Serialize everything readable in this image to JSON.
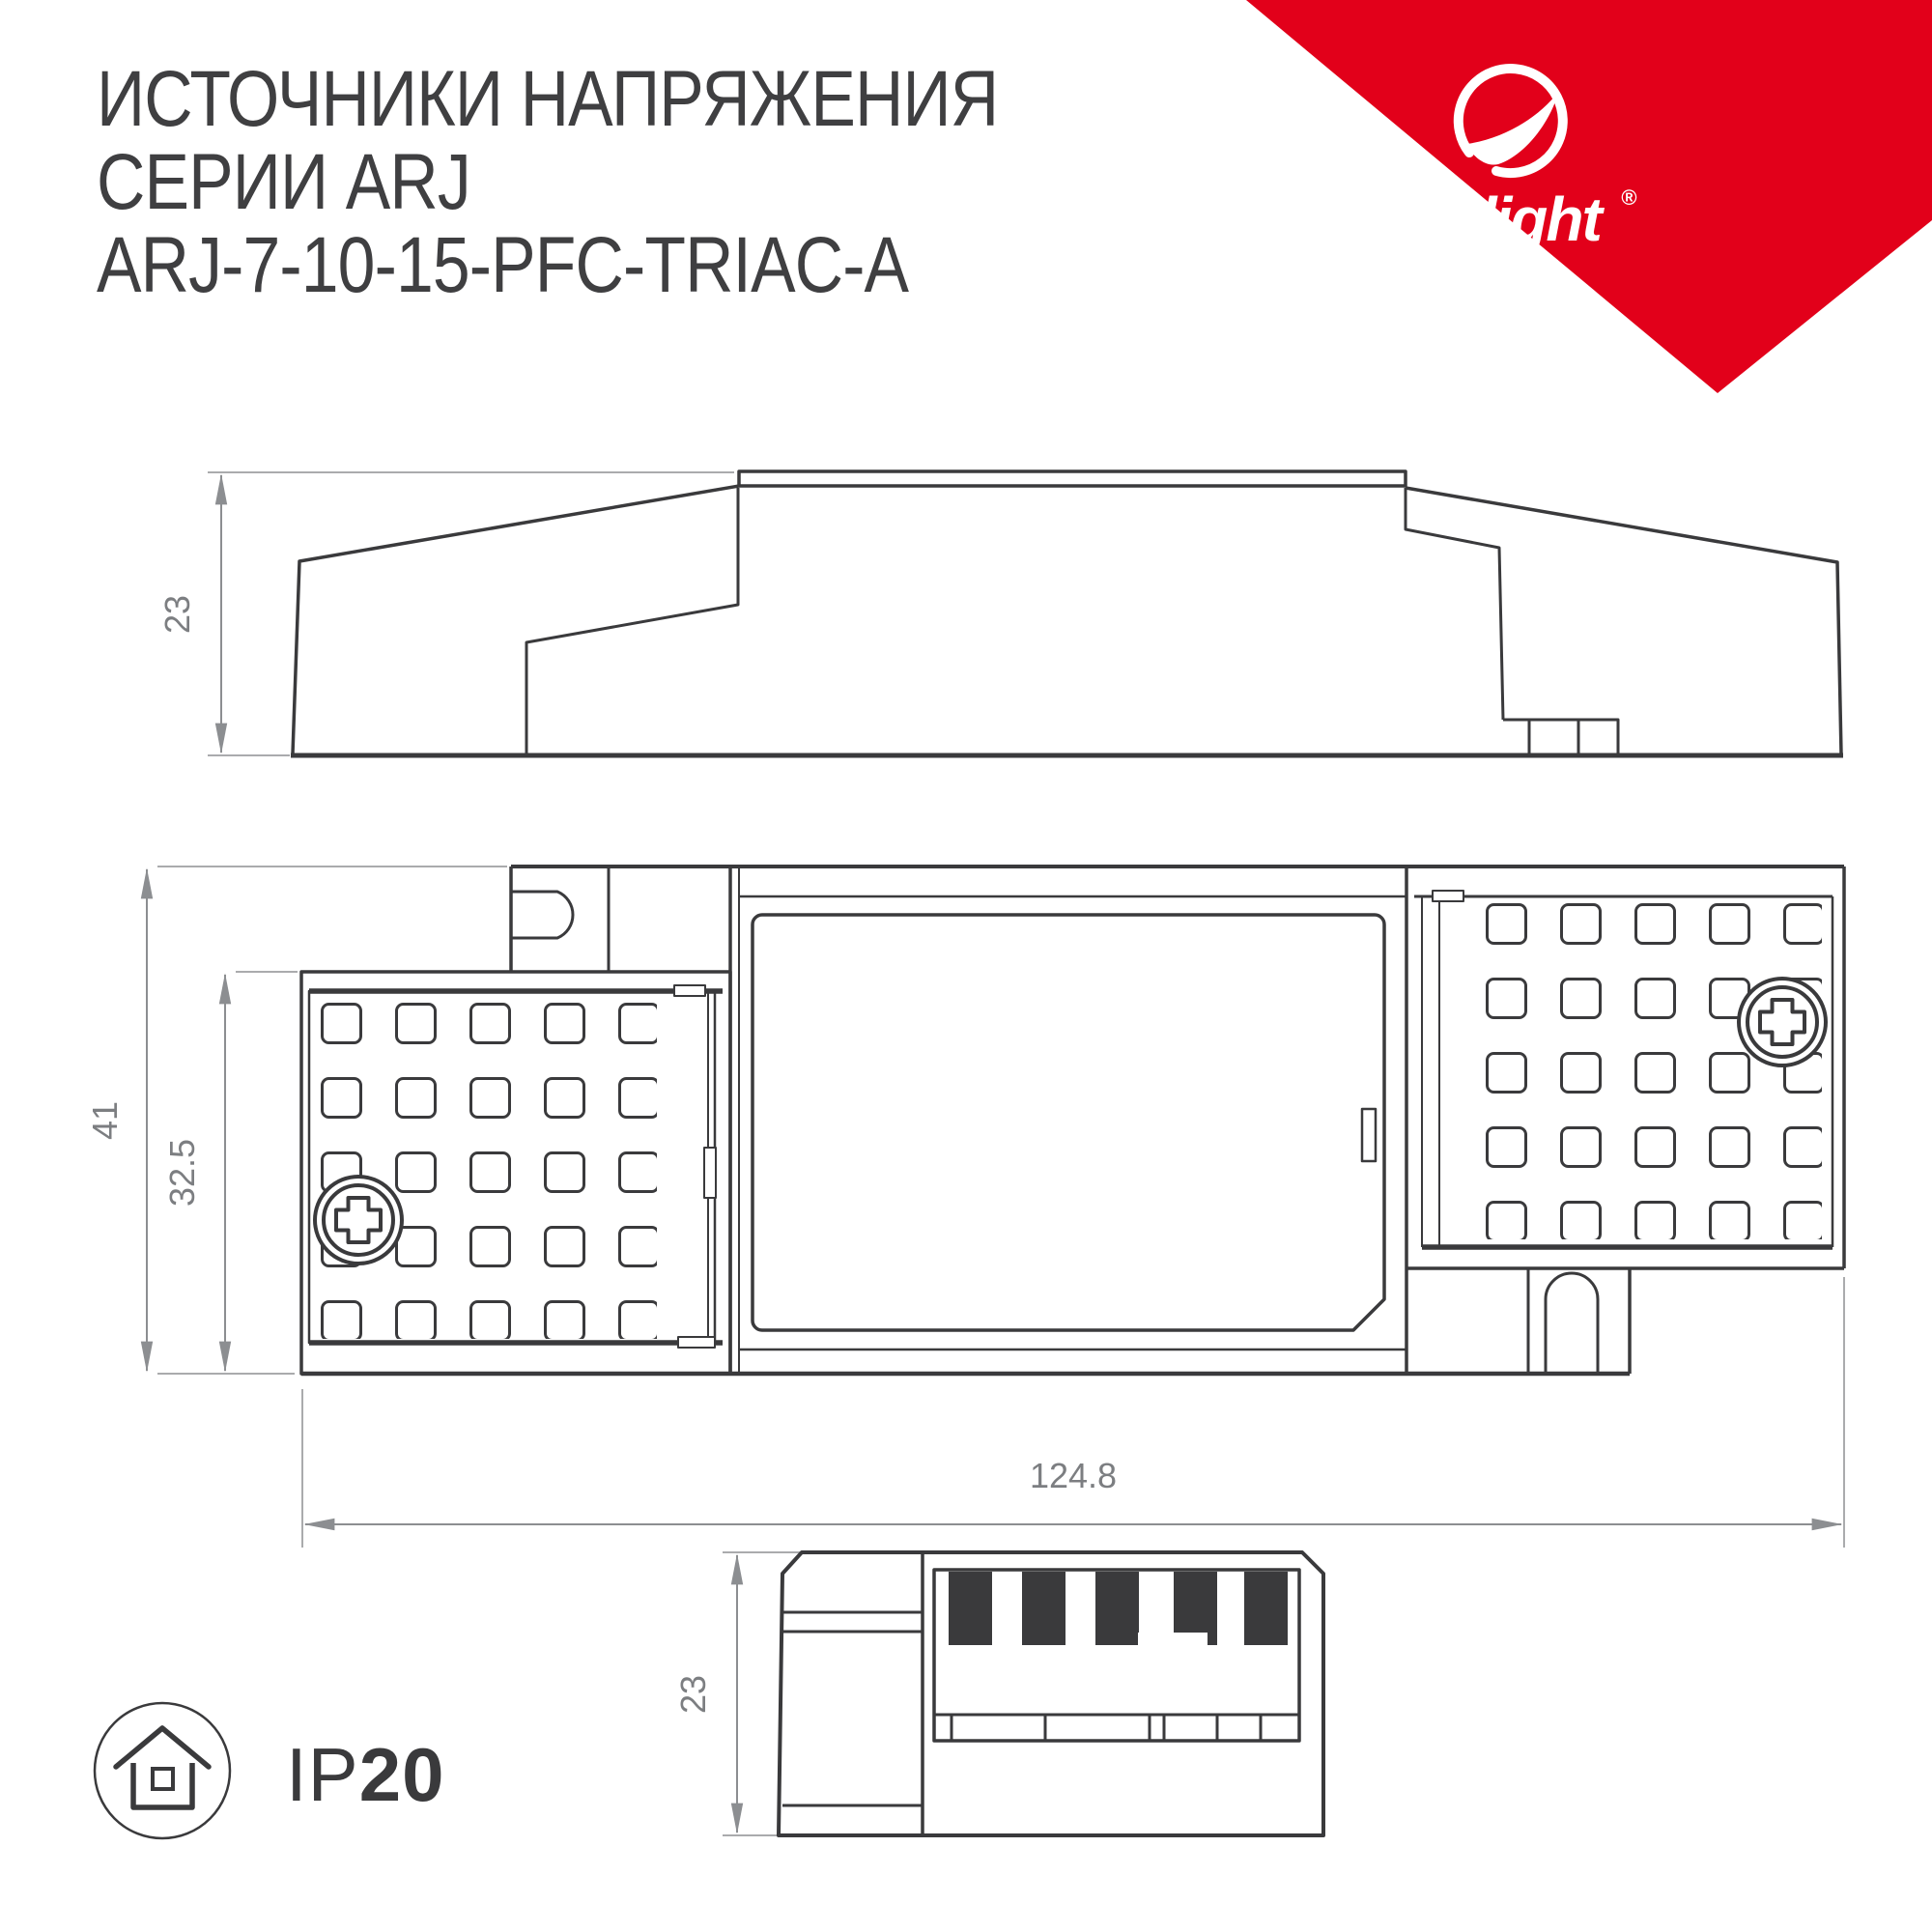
{
  "title": {
    "line1": "ИСТОЧНИКИ НАПРЯЖЕНИЯ",
    "line2": "СЕРИИ ARJ",
    "line3": "ARJ-7-10-15-PFC-TRIAC-A"
  },
  "brand": {
    "name": "arlight",
    "registered": "®",
    "triangle_color": "#e2001a"
  },
  "views": {
    "side": {
      "dim_height": "23"
    },
    "front": {
      "dim_total_height": "41",
      "dim_box_height": "32.5",
      "dim_width": "124.8"
    },
    "end": {
      "dim_height": "23"
    }
  },
  "badge": {
    "prefix": "IP",
    "rating": "20"
  },
  "icons": {
    "swoosh": "arlight-leaf-swoosh-icon",
    "protection": "house-in-circle-icon",
    "screw": "phillips-screw-icon"
  },
  "colors": {
    "line": "#3a3a3c",
    "dark_fill": "#3a3a3c",
    "dim_line": "#8c8e91",
    "ext_line": "#aaabad",
    "dim_text": "#7c7e81",
    "brand_red": "#e2001a"
  }
}
